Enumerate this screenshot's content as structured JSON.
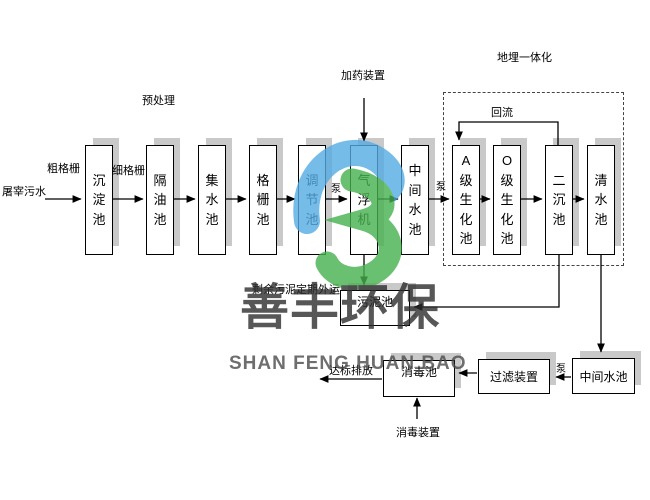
{
  "labels": {
    "influent": "屠宰污水",
    "coarse_screen": "粗格栅",
    "fine_screen": "细格栅",
    "pretreatment": "预处理",
    "dosing_device": "加药装置",
    "buried_integration": "地埋一体化",
    "reflux": "回流",
    "pump": "泵",
    "sludge_out": "剩余污泥定期外运",
    "discharge": "达标排放",
    "disinfection_device": "消毒装置"
  },
  "tanks": {
    "sedimentation": "沉淀池",
    "oil_separation": "隔油池",
    "collection": "集水池",
    "screen": "格栅池",
    "regulating": "调节池",
    "air_flotation": "气浮机",
    "intermediate_top": "中间水池",
    "a_bio": "A级生化池",
    "o_bio": "O级生化池",
    "secondary_sed": "二沉池",
    "clear_water": "清水池",
    "sludge": "污泥池",
    "disinfection": "消毒池",
    "filter": "过滤装置",
    "intermediate_bottom": "中间水池"
  },
  "watermark": {
    "cn": "善丰环保",
    "en": "SHAN FENG HUAN BAO"
  },
  "colors": {
    "logo_blue": "#55ace3",
    "logo_green": "#46b14e",
    "shadow_gray": "#c9c9c9",
    "line_black": "#000000"
  }
}
